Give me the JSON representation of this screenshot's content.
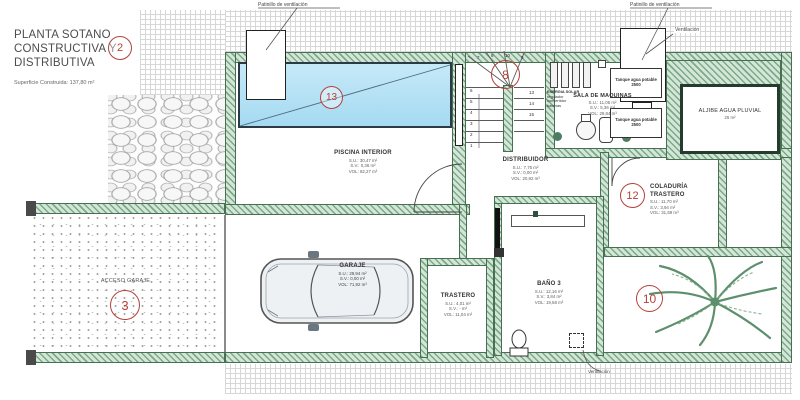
{
  "title": {
    "lines": [
      "PLANTA SOTANO",
      "CONSTRUCTIVA Y",
      "DISTRIBUTIVA"
    ],
    "badge": "2",
    "area_note": "Superficie Construida: 137,80 m²"
  },
  "annotations": {
    "patinillo": "Patinillo de ventilación",
    "ventilacion": "Ventilación"
  },
  "rooms": {
    "piscina": {
      "name": "PISCINA INTERIOR",
      "su": "S.U.: 30,47 m²",
      "sv": "S.V.: 0,36 m²",
      "vol": "VOL: 82,27 m³",
      "badge": "13"
    },
    "sala_maquinas": {
      "name": "SALA DE MAQUINAS",
      "su": "S.U.: 11,05 m²",
      "sv": "S.V.: 5,36 m²",
      "vol": "VOL: 29,84 m³"
    },
    "aljibe": {
      "name": "ALJIBE AGUA PLUVIAL",
      "area": "25 m²"
    },
    "distribuidor": {
      "name": "DISTRIBUIDOR",
      "su": "S.U.: 7,75 m²",
      "sv": "S.V.: 0,00 m²",
      "vol": "VOL: 20,92 m³"
    },
    "coladuria": {
      "name": "COLADURÍA TRASTERO",
      "su": "S.U.: 11,70 m²",
      "sv": "S.V.: 3,94 m²",
      "vol": "VOL: 31,59 m³",
      "badge": "12"
    },
    "garaje": {
      "name": "GARAJE",
      "su": "S.U.: 29,94 m²",
      "sv": "S.V.: 0,00 m²",
      "vol": "VOL: 71,92 m³"
    },
    "trastero": {
      "name": "TRASTERO",
      "su": "S.U.: 4,01 m²",
      "sv": "S.V.: - m²",
      "vol": "VOL: 11,04 m³"
    },
    "bano3": {
      "name": "BAÑO 3",
      "su": "S.U.: 12,16 m²",
      "sv": "S.V.: 3,84 m²",
      "vol": "VOL: 19,58 m³"
    },
    "acceso_garaje": {
      "name": "ACCESO GARAJE",
      "badge": "3"
    },
    "patio_palmera": {
      "badge": "10"
    }
  },
  "stairs": {
    "badge": "8",
    "steps": [
      "1",
      "2",
      "3",
      "4",
      "5",
      "6",
      "7",
      "8",
      "9",
      "10",
      "13",
      "14",
      "15"
    ]
  },
  "equipment": {
    "energia": {
      "title": "ENERGIA SOLAR",
      "l1": "regulador",
      "l2": "convertidor",
      "l3": "baterías"
    },
    "tanque": {
      "name": "Tanque agua potable",
      "cap": "2500"
    }
  },
  "colors": {
    "wall_green": "#7da98b",
    "accent_red": "#b5403a",
    "pool_blue": "#b7e0f4",
    "palm_green": "#5d8f6d"
  }
}
